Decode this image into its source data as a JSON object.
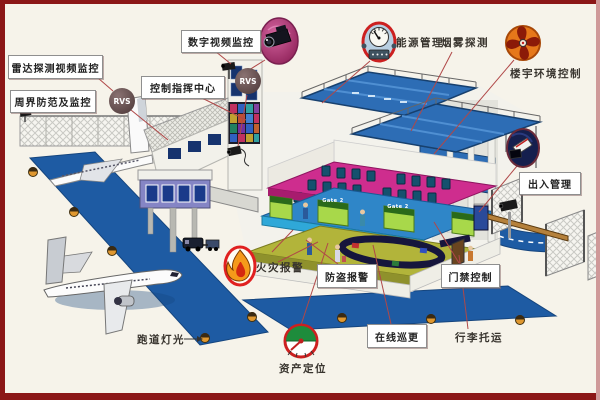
{
  "title": "airport-security-systems-diagram",
  "colors": {
    "frame_border": "#8b1717",
    "background": "#f6f3ea",
    "road_blue": "#1e5ba3",
    "roof_blue": "#2d6db5",
    "floor_magenta": "#ce2d8e",
    "floor_olive": "#b2b43a",
    "gate_green": "#a8d84a",
    "connector_red": "#b04848"
  },
  "boxed_labels": [
    {
      "id": "digital-video-surveillance",
      "text": "数字视频监控"
    },
    {
      "id": "radar-video-surveillance",
      "text": "雷达探测视频监控"
    },
    {
      "id": "control-command-center",
      "text": "控制指挥中心"
    },
    {
      "id": "perimeter-protection",
      "text": "周界防范及监控"
    },
    {
      "id": "entry-exit-management",
      "text": "出入管理"
    },
    {
      "id": "burglar-alarm",
      "text": "防盗报警"
    },
    {
      "id": "door-access-control",
      "text": "门禁控制"
    },
    {
      "id": "online-patrol",
      "text": "在线巡更"
    }
  ],
  "plain_labels": [
    {
      "id": "energy-management",
      "text": "能源管理"
    },
    {
      "id": "smoke-detection",
      "text": "烟雾探测"
    },
    {
      "id": "building-environment-control",
      "text": "楼宇环境控制"
    },
    {
      "id": "fire-alarm",
      "text": "火灾报警"
    },
    {
      "id": "runway-lighting",
      "text": "跑道灯光"
    },
    {
      "id": "baggage-handling",
      "text": "行李托运"
    },
    {
      "id": "asset-location",
      "text": "资产定位"
    }
  ],
  "badges": {
    "rvs": "RVS",
    "gate_sign": "Gate 2"
  },
  "icons": [
    {
      "name": "cctv-camera-icon"
    },
    {
      "name": "energy-gauge-icon"
    },
    {
      "name": "exhaust-fan-icon"
    },
    {
      "name": "access-card-reader-icon"
    },
    {
      "name": "fire-flame-icon"
    },
    {
      "name": "asset-gauge-icon"
    },
    {
      "name": "rvs-badge"
    }
  ]
}
